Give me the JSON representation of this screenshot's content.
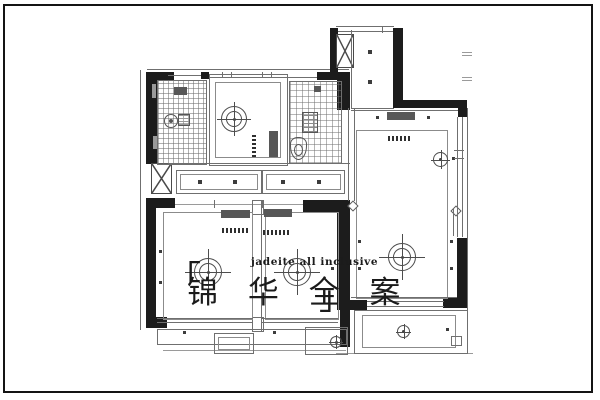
{
  "watermark": {
    "bracket_open": "「",
    "title_cn": "锦 华 全 案",
    "bracket_close": "」",
    "subtitle_en": "jadeite all inclusive"
  },
  "colors": {
    "background": "#ffffff",
    "border_frame": "#141414",
    "wall_fill": "#1c1c1c",
    "thin_line": "#6f6f6f",
    "tile_grid": "#6e6e6e",
    "fixture_dark": "#575757",
    "watermark_text": "#1b1b1b"
  },
  "symbols": {
    "ceiling-lamp-icon": "double-circle with crosshair",
    "chandelier-icon": "large double-circle with extended crosshair",
    "downlight-icon": "small square dot",
    "shaft-icon": "box with X diagonals",
    "curtain-track-icon": "dashed bar",
    "vent-grille-icon": "hatched box",
    "exhaust-fan-icon": "circle with center dot",
    "toilet-icon": "rounded bowl outline"
  }
}
